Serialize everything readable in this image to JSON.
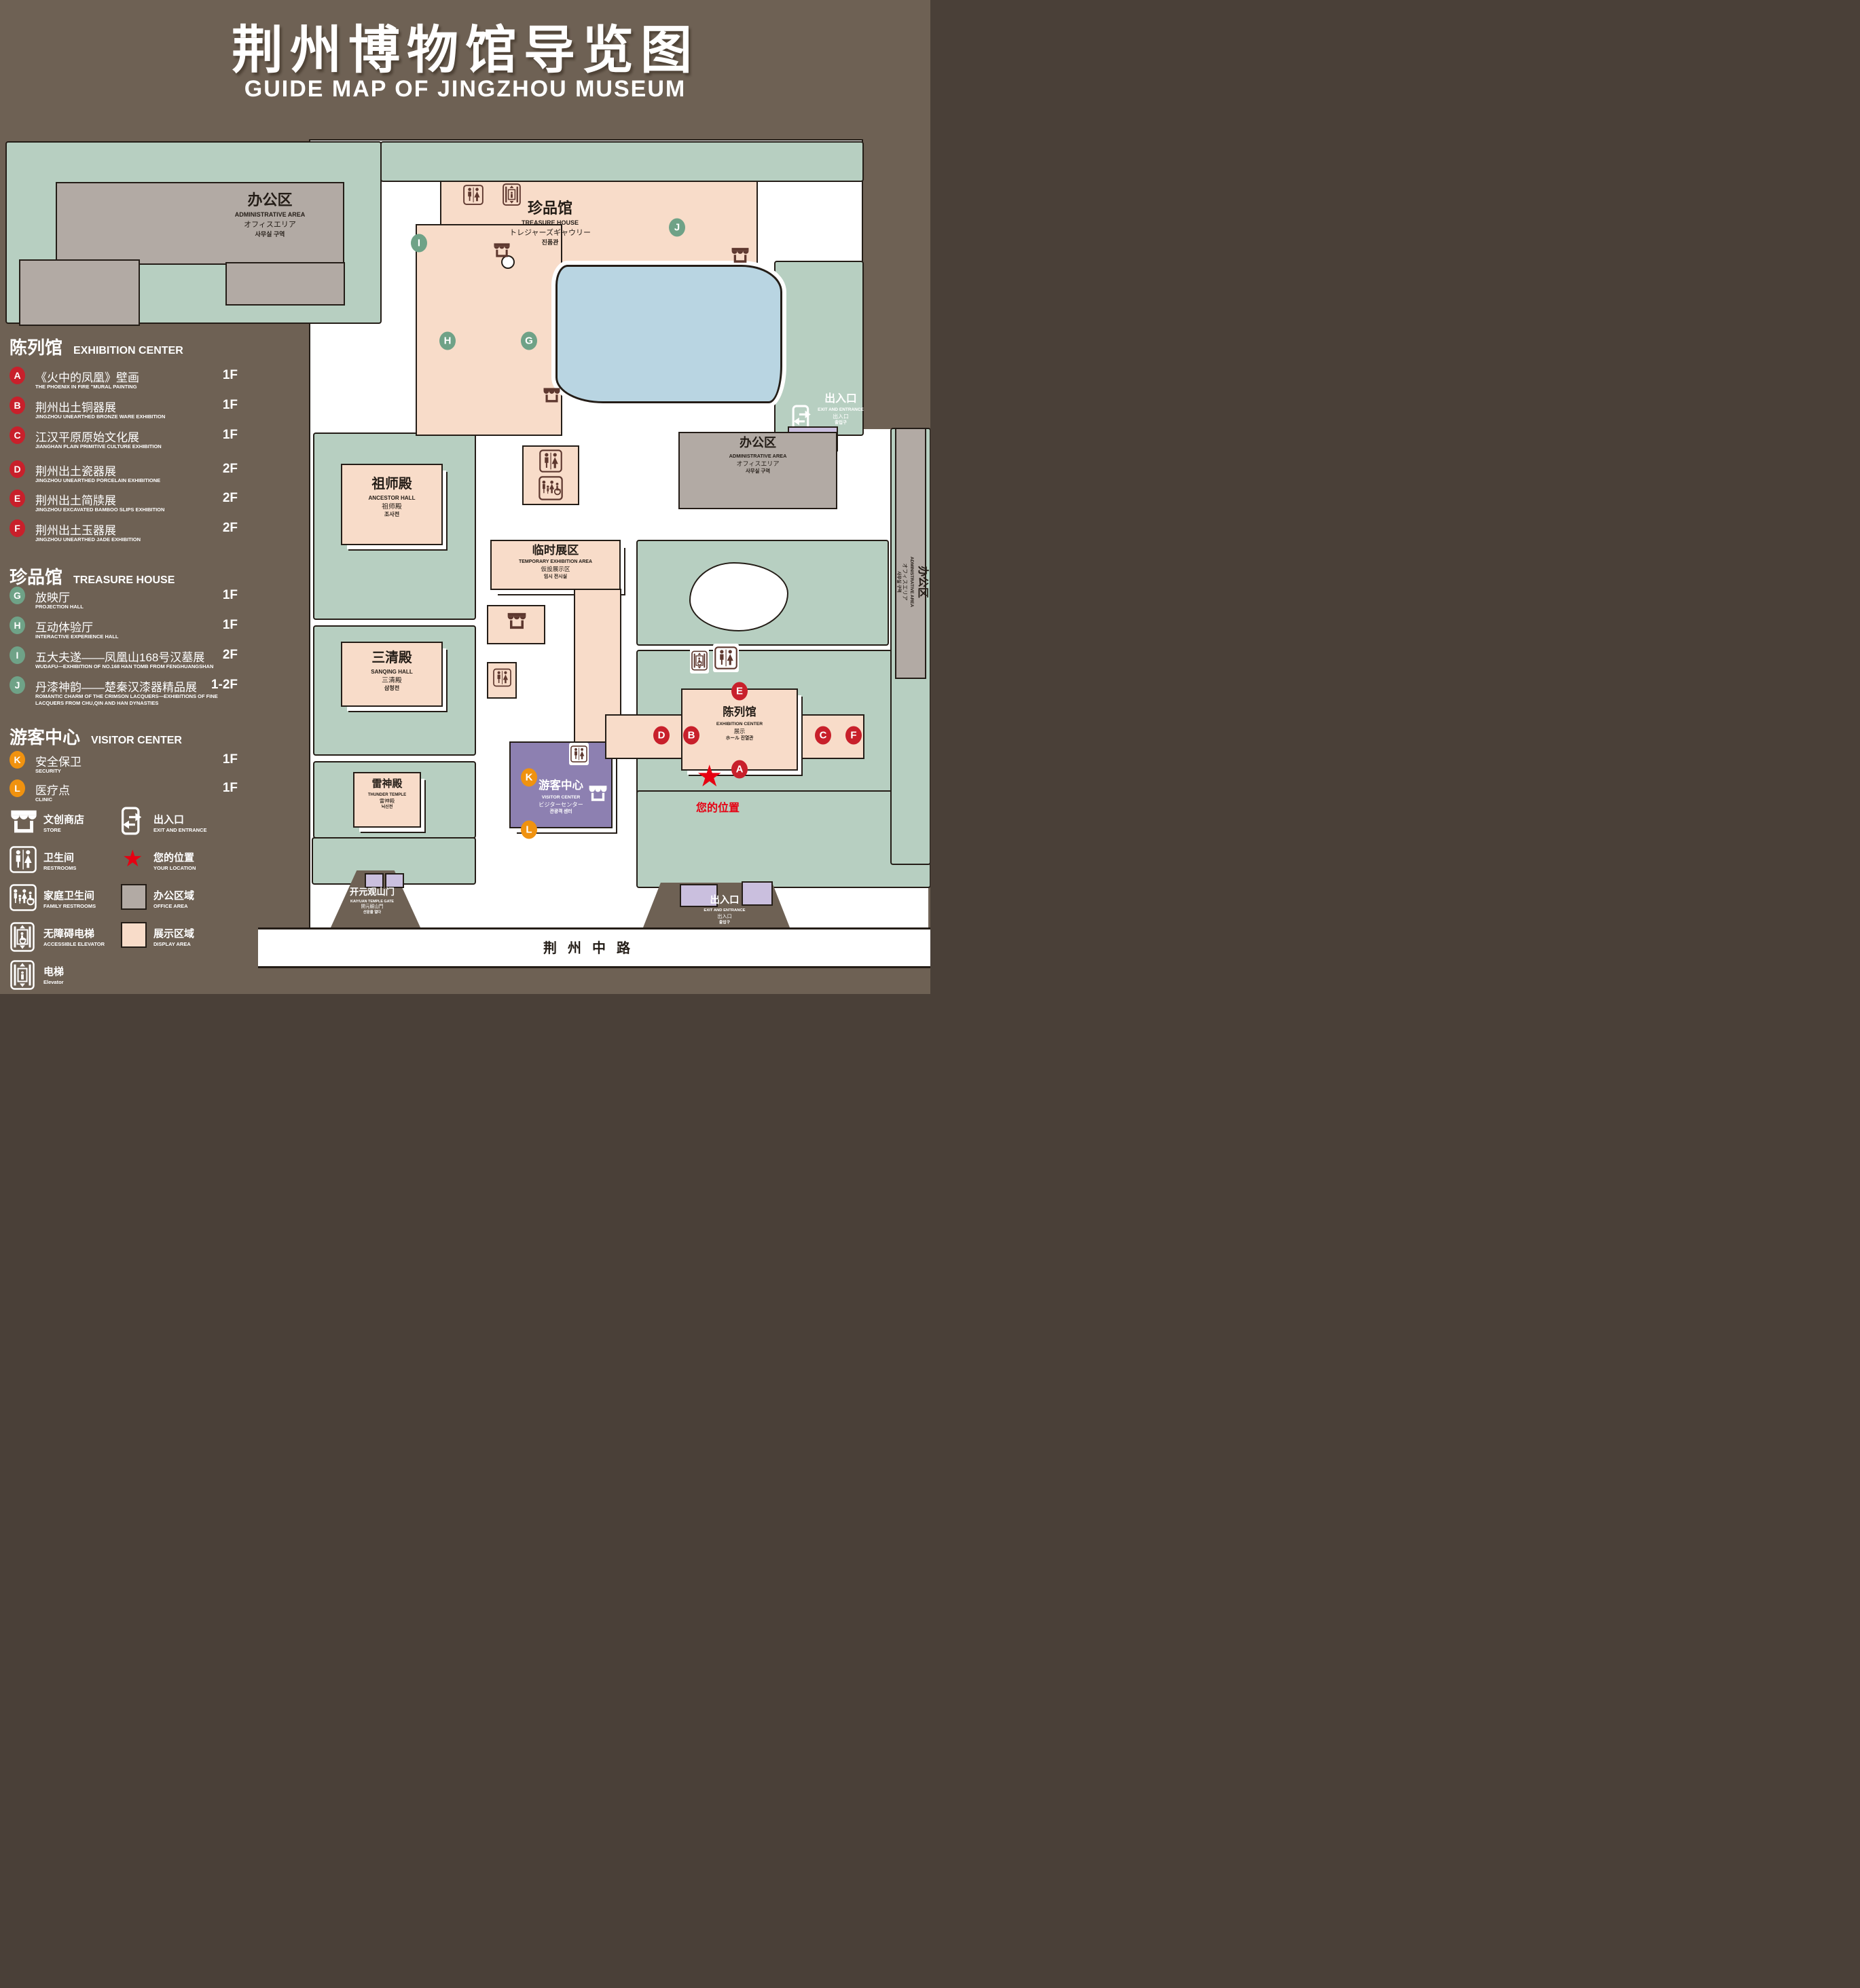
{
  "title": {
    "cn": "荆州博物馆导览图",
    "en": "GUIDE MAP OF JINGZHOU MUSEUM"
  },
  "legend": {
    "sections": [
      {
        "cn": "陈列馆",
        "en": "EXHIBITION CENTER",
        "items": [
          {
            "letter": "A",
            "cn": "《火中的凤凰》壁画",
            "en": "THE PHOENIX IN FIRE \"MURAL PAINTING",
            "floor": "1F"
          },
          {
            "letter": "B",
            "cn": "荆州出土铜器展",
            "en": "JINGZHOU UNEARTHED BRONZE WARE EXHIBITION",
            "floor": "1F"
          },
          {
            "letter": "C",
            "cn": "江汉平原原始文化展",
            "en": "JIANGHAN PLAIN PRIMITIVE CULTURE EXHIBITION",
            "floor": "1F"
          },
          {
            "letter": "D",
            "cn": "荆州出土瓷器展",
            "en": "JINGZHOU UNEARTHED PORCELAIN EXHIBITIONE",
            "floor": "2F"
          },
          {
            "letter": "E",
            "cn": "荆州出土简牍展",
            "en": "JINGZHOU EXCAVATED BAMBOO SLIPS EXHIBITION",
            "floor": "2F"
          },
          {
            "letter": "F",
            "cn": "荆州出土玉器展",
            "en": "JINGZHOU UNEARTHED JADE EXHIBITION",
            "floor": "2F"
          }
        ]
      },
      {
        "cn": "珍品馆",
        "en": "TREASURE HOUSE",
        "items": [
          {
            "letter": "G",
            "cn": "放映厅",
            "en": "PROJECTION HALL",
            "floor": "1F"
          },
          {
            "letter": "H",
            "cn": "互动体验厅",
            "en": "INTERACTIVE EXPERIENCE HALL",
            "floor": "1F"
          },
          {
            "letter": "I",
            "cn": "五大夫遂——凤凰山168号汉墓展",
            "en": "WUDAFU—EXHIBITION OF NO.168 HAN TOMB FROM FENGHUANGSHAN",
            "floor": "2F"
          },
          {
            "letter": "J",
            "cn": "丹漆神韵——楚秦汉漆器精品展",
            "en": "ROMANTIC CHARM OF THE CRIMSON LACQUERS—EXHIBITIONS OF FINE LACQUERS FROM CHU,QIN AND HAN DYNASTIES",
            "floor": "1-2F"
          }
        ]
      },
      {
        "cn": "游客中心",
        "en": "VISITOR CENTER",
        "items": [
          {
            "letter": "K",
            "cn": "安全保卫",
            "en": "SECURITY",
            "floor": "1F"
          },
          {
            "letter": "L",
            "cn": "医疗点",
            "en": "CLINIC",
            "floor": "1F"
          }
        ]
      }
    ],
    "symbols": {
      "store": {
        "cn": "文创商店",
        "en": "STORE"
      },
      "restrooms": {
        "cn": "卫生间",
        "en": "RESTROOMS"
      },
      "family": {
        "cn": "家庭卫生间",
        "en": "FAMILY RESTROOMS"
      },
      "accessible": {
        "cn": "无障碍电梯",
        "en": "ACCESSIBLE ELEVATOR"
      },
      "elevator": {
        "cn": "电梯",
        "en": "Elevator"
      },
      "exit": {
        "cn": "出入口",
        "en": "EXIT AND ENTRANCE"
      },
      "location": {
        "cn": "您的位置",
        "en": "YOUR LOCATION"
      },
      "office": {
        "cn": "办公区域",
        "en": "OFFICE AREA"
      },
      "display": {
        "cn": "展示区域",
        "en": "DISPLAY AREA"
      }
    }
  },
  "map": {
    "buildings": {
      "admin": {
        "cn": "办公区",
        "en": "ADMINISTRATIVE AREA",
        "ja": "オフィスエリア",
        "ko": "사무실 구역"
      },
      "treasure": {
        "cn": "珍品馆",
        "en": "TREASURE HOUSE",
        "ja": "トレジャーズギャウリー",
        "ko": "진품관"
      },
      "ancestor": {
        "cn": "祖师殿",
        "en": "ANCESTOR HALL",
        "ja": "祖师殿",
        "ko": "조사전"
      },
      "sanqing": {
        "cn": "三清殿",
        "en": "SANQING HALL",
        "ja": "三清殿",
        "ko": "삼청전"
      },
      "thunder": {
        "cn": "雷神殿",
        "en": "THUNDER TEMPLE",
        "ja": "雷神殿",
        "ko": "뇌신전"
      },
      "temporary": {
        "cn": "临时展区",
        "en": "TEMPORARY EXHIBITION AREA",
        "ja": "仮設展示区",
        "ko": "임시 전시실"
      },
      "visitor": {
        "cn": "游客中心",
        "en": "VISITOR CENTER",
        "ja": "ビジターセンター",
        "ko": "관광객 센터"
      },
      "exhibition": {
        "cn": "陈列馆",
        "en": "EXHIBITION CENTER",
        "ja": "展示",
        "ko": "ホール 진열관"
      },
      "gate": {
        "cn": "开元观山门",
        "en": "KAIYUAN TEMPLE GATE",
        "ja": "開元観山門",
        "ko": "산문을 열다"
      },
      "exit": {
        "cn": "出入口",
        "en": "EXIT AND ENTRANCE",
        "ja": "出入口",
        "ko": "출입구"
      }
    },
    "road": "荆州中路",
    "your_location": "您的位置"
  },
  "colors": {
    "background": "#6e6154",
    "lawn": "#b7cfc1",
    "display_area": "#f8dcc9",
    "office_area": "#b2aaa4",
    "water": "#b9d5e2",
    "visitor_center": "#8d80b1",
    "light_purple": "#cabfde",
    "marker_red": "#c8202b",
    "marker_green": "#6fa287",
    "marker_orange": "#f0920f",
    "icon_brown": "#5e382f",
    "location_red": "#e60012"
  }
}
